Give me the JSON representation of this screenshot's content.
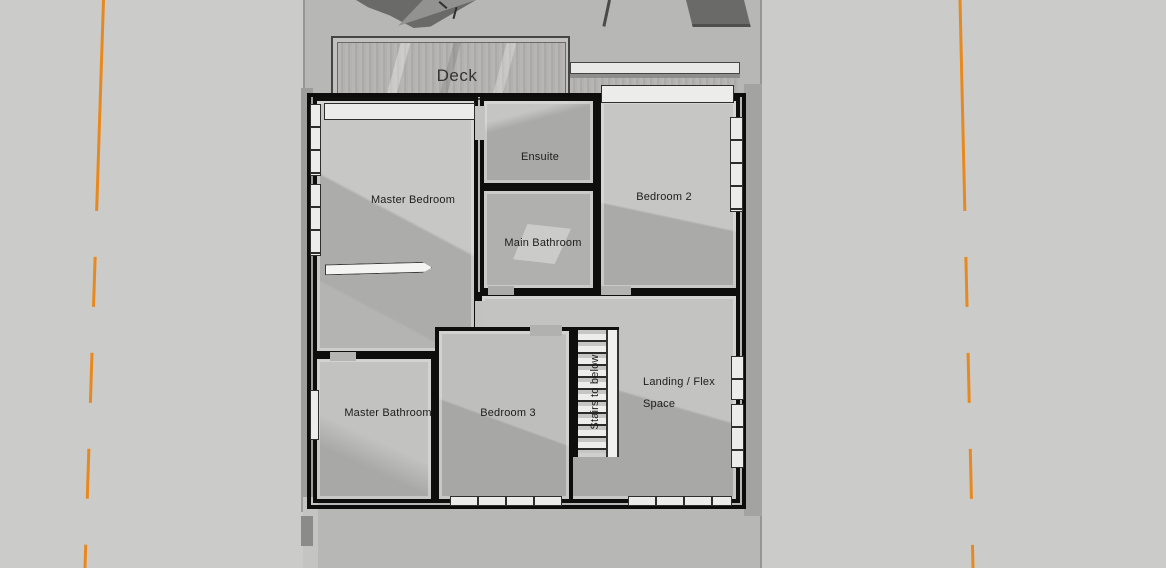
{
  "view": {
    "type_label": "3d-floor-plan-top-view",
    "background_color": "#cbcbc9",
    "site_ground_color": "#b7b7b5",
    "boundary_line_color": "#e8891f",
    "wall_color": "#0e0e0c",
    "floor_light_color": "#c6c6c4",
    "floor_shadow_color": "#a9a9a7"
  },
  "floorplan": {
    "deck": {
      "label": "Deck"
    },
    "rooms": [
      {
        "id": "master-bedroom",
        "label": "Master Bedroom"
      },
      {
        "id": "ensuite",
        "label": "Ensuite"
      },
      {
        "id": "bedroom-2",
        "label": "Bedroom 2"
      },
      {
        "id": "main-bathroom",
        "label": "Main Bathroom"
      },
      {
        "id": "master-bathroom",
        "label": "Master Bathroom"
      },
      {
        "id": "bedroom-3",
        "label": "Bedroom 3"
      },
      {
        "id": "landing",
        "label_line1": "Landing / Flex",
        "label_line2": "Space"
      }
    ],
    "stairs": {
      "label": "Stairs to below"
    }
  }
}
